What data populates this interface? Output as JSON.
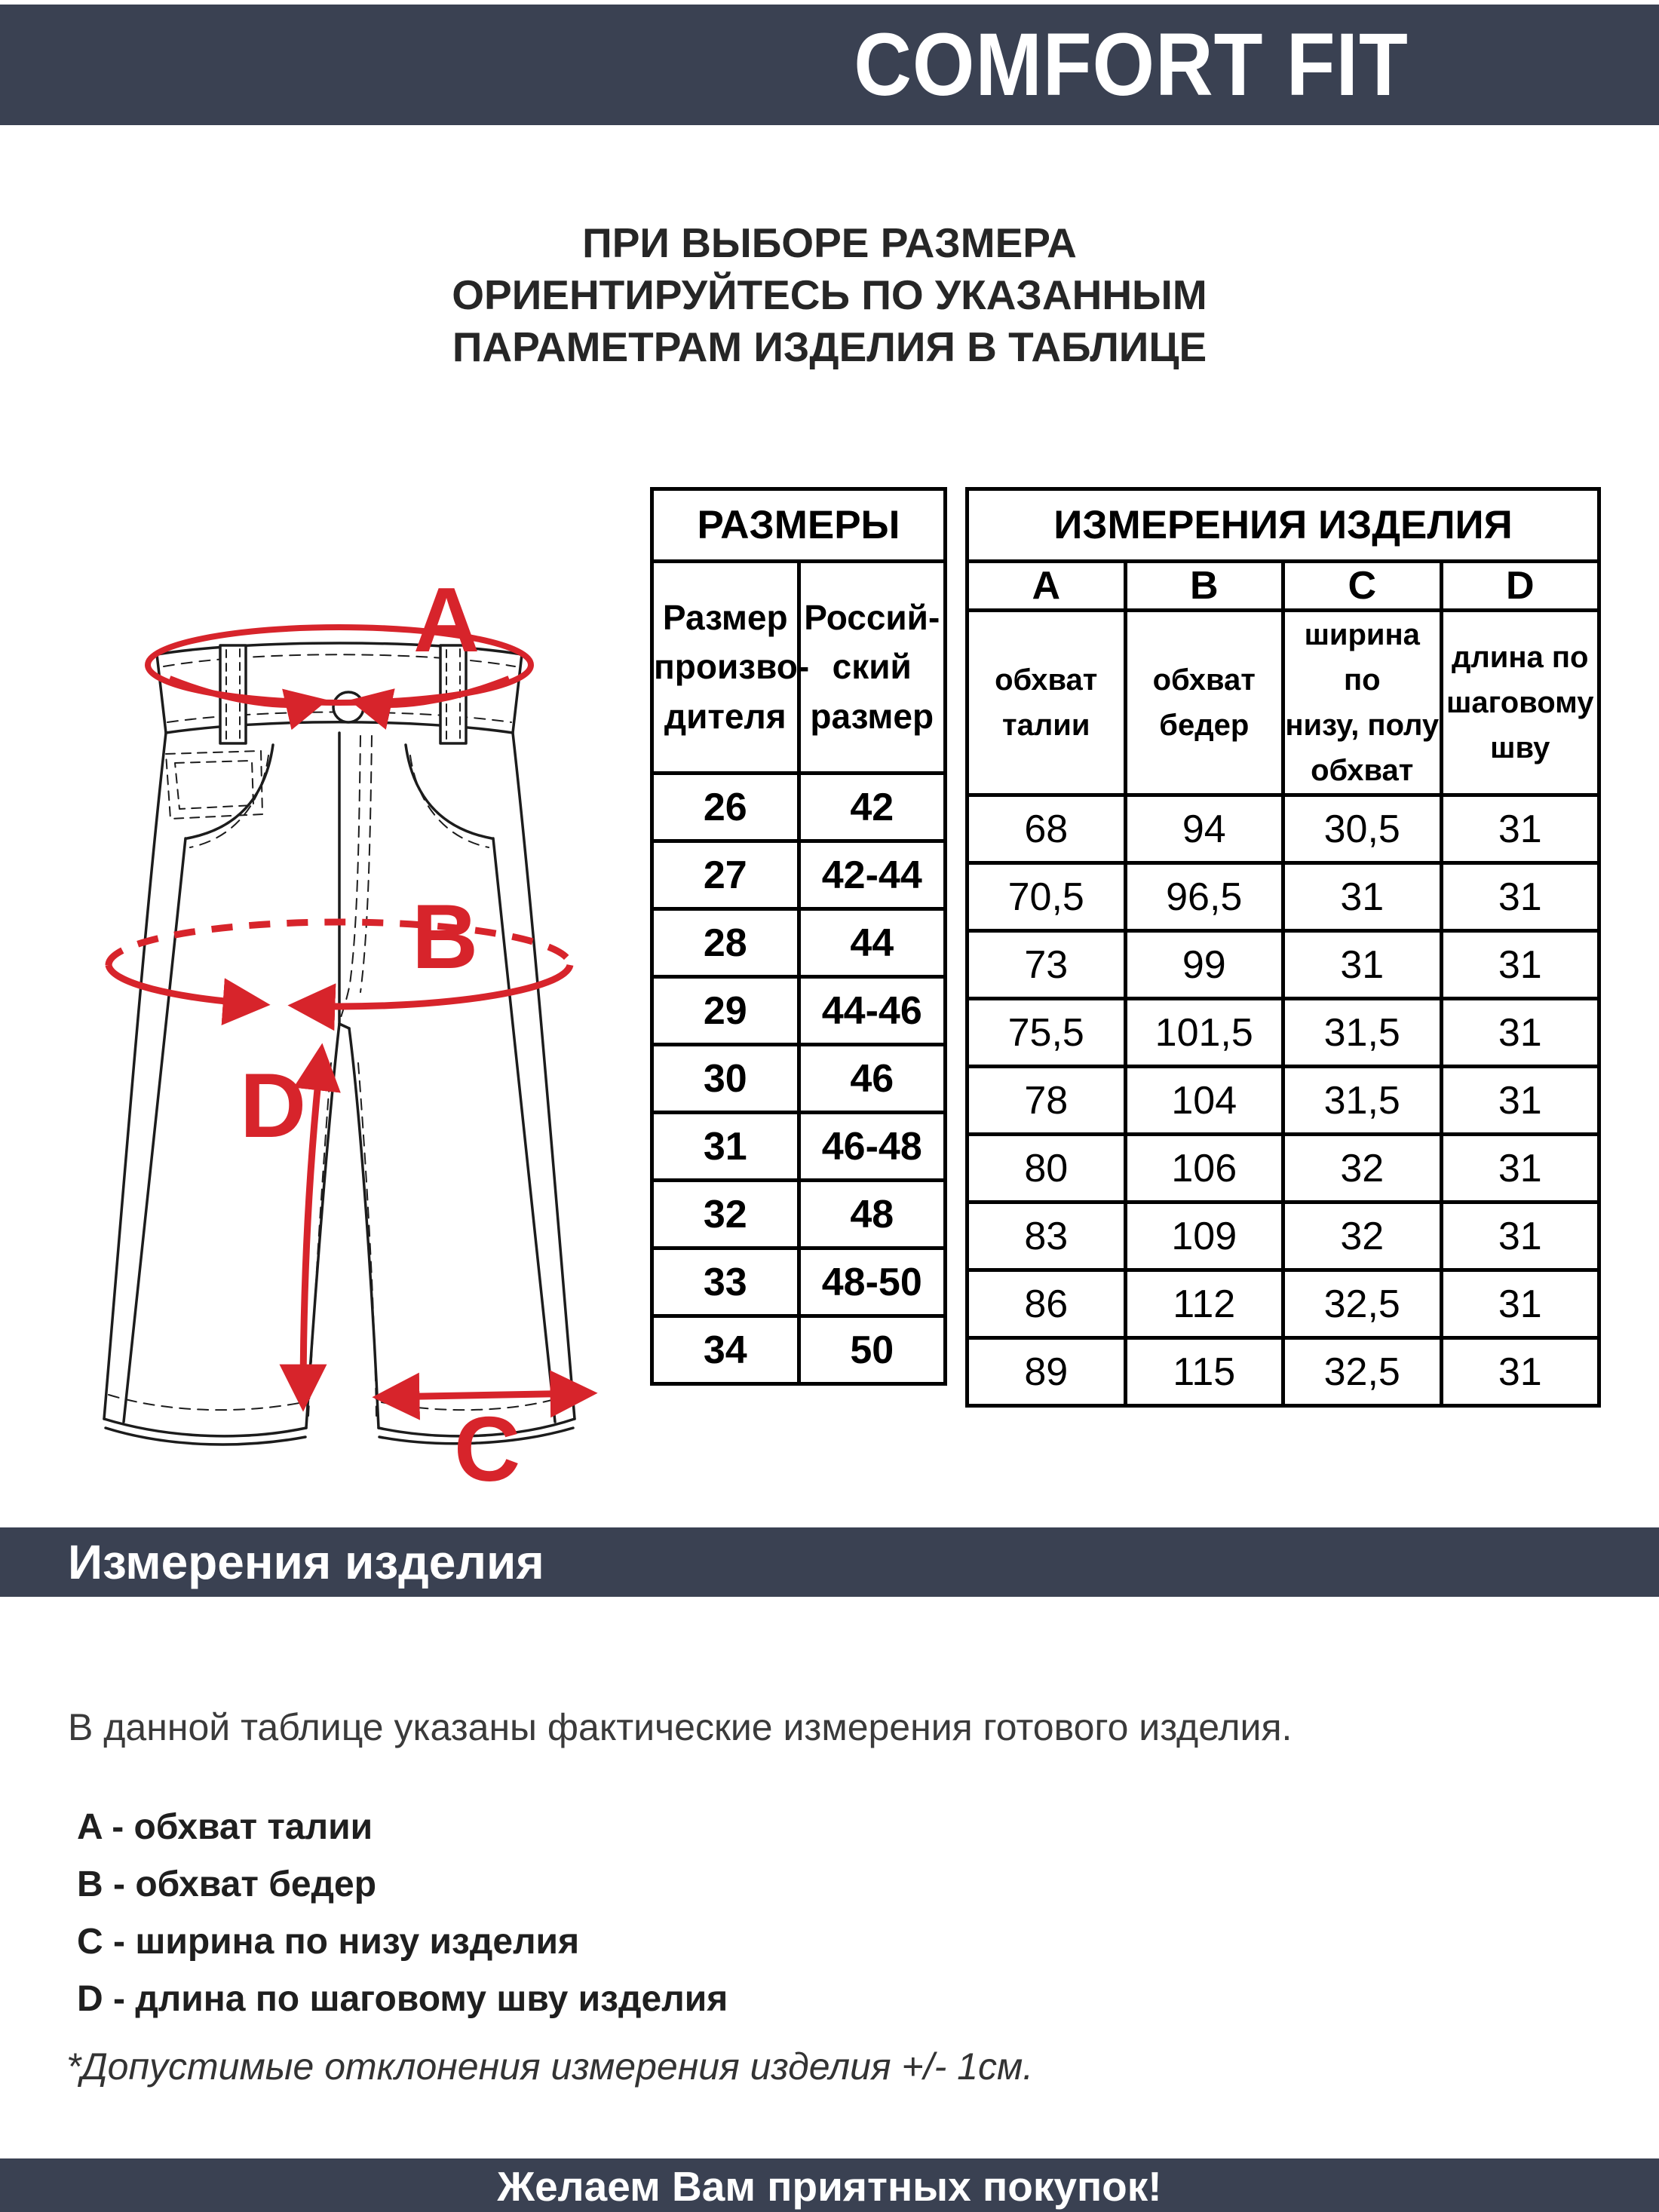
{
  "header": {
    "brand": "COMFORT FIT"
  },
  "intro": "ПРИ ВЫБОРЕ РАЗМЕРА\nОРИЕНТИРУЙТЕСЬ ПО УКАЗАННЫМ\nПАРАМЕТРАМ ИЗДЕЛИЯ В ТАБЛИЦЕ",
  "diagram": {
    "label_a": "A",
    "label_b": "B",
    "label_c": "C",
    "label_d": "D"
  },
  "table": {
    "sizes_title": "РАЗМЕРЫ",
    "maker_size_header": "Размер\nпроизво-\nдителя",
    "ru_size_header": "Россий-\nский\nразмер",
    "measures_title": "ИЗМЕРЕНИЯ ИЗДЕЛИЯ",
    "letters": [
      "A",
      "B",
      "C",
      "D"
    ],
    "letter_descriptions": [
      "обхват\nталии",
      "обхват\nбедер",
      "ширина по\nнизу, полу\nобхват",
      "длина по\nшаговому\nшву"
    ],
    "rows": [
      [
        "26",
        "42",
        "68",
        "94",
        "30,5",
        "31"
      ],
      [
        "27",
        "42-44",
        "70,5",
        "96,5",
        "31",
        "31"
      ],
      [
        "28",
        "44",
        "73",
        "99",
        "31",
        "31"
      ],
      [
        "29",
        "44-46",
        "75,5",
        "101,5",
        "31,5",
        "31"
      ],
      [
        "30",
        "46",
        "78",
        "104",
        "31,5",
        "31"
      ],
      [
        "31",
        "46-48",
        "80",
        "106",
        "32",
        "31"
      ],
      [
        "32",
        "48",
        "83",
        "109",
        "32",
        "31"
      ],
      [
        "33",
        "48-50",
        "86",
        "112",
        "32,5",
        "31"
      ],
      [
        "34",
        "50",
        "89",
        "115",
        "32,5",
        "31"
      ]
    ]
  },
  "section_bar": {
    "title": "Измерения изделия"
  },
  "notes": {
    "intro": "В данной таблице указаны фактические измерения готового изделия.",
    "legend": [
      "A - обхват талии",
      "B - обхват бедер",
      "C - ширина по низу изделия",
      "D - длина по шаговому шву изделия"
    ],
    "disclaimer": "*Допустимые отклонения измерения изделия +/- 1см."
  },
  "footer": {
    "message": "Желаем Вам приятных покупок!"
  },
  "colors": {
    "navy": "#3a4152",
    "accent_red": "#d7242b"
  }
}
